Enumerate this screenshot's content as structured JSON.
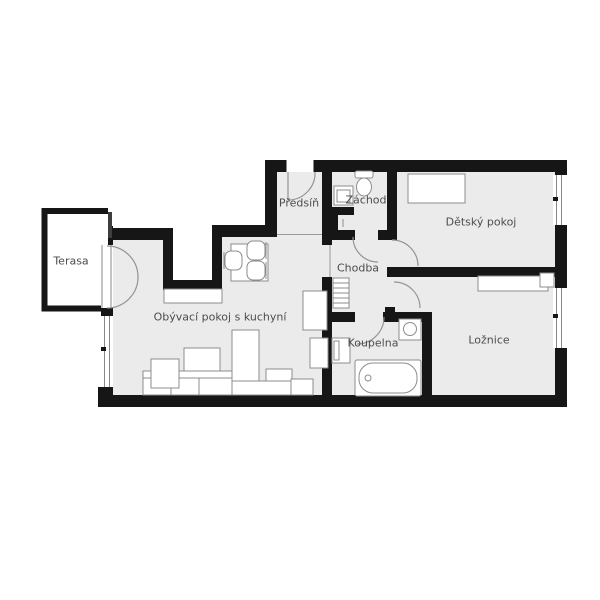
{
  "logo": {
    "brand": "instinkt",
    "tagline": "REALITY"
  },
  "colors": {
    "accent": "#F0E14C",
    "wall": "#161616",
    "floor": "#EBEBEB",
    "outside": "#FFFFFF",
    "label": "#4D4D4D",
    "furniture-stroke": "#8C8C8C"
  },
  "rooms": {
    "terasa": {
      "label": "Terasa"
    },
    "living": {
      "label": "Obývací pokoj s kuchyní"
    },
    "predsin": {
      "label": "Předsíň"
    },
    "zachod": {
      "label": "Záchod"
    },
    "chodba": {
      "label": "Chodba"
    },
    "detsky": {
      "label": "Dětský pokoj"
    },
    "koupelna": {
      "label": "Koupelna"
    },
    "loznice": {
      "label": "Ložnice"
    }
  }
}
